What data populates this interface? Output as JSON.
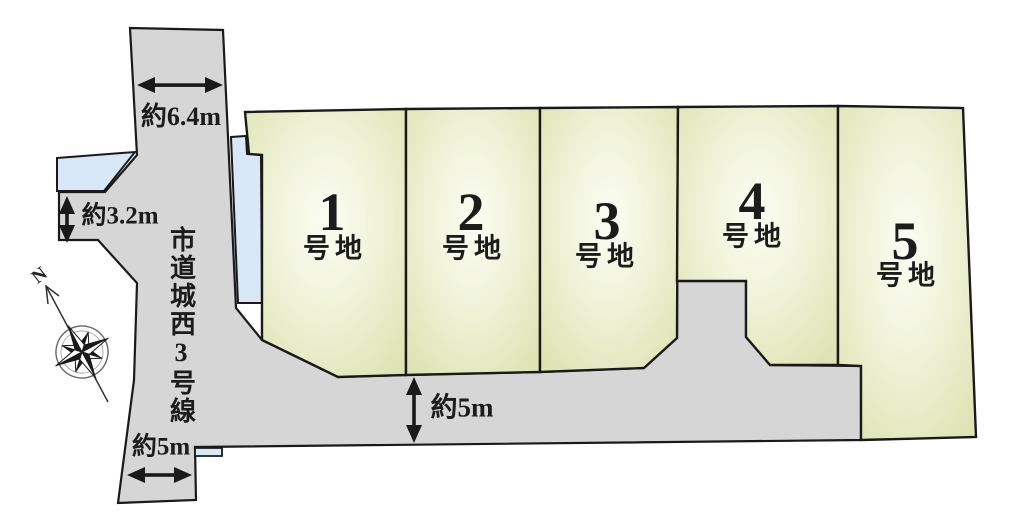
{
  "diagram": {
    "lots": [
      {
        "number": "1",
        "suffix": "号地"
      },
      {
        "number": "2",
        "suffix": "号地"
      },
      {
        "number": "3",
        "suffix": "号地"
      },
      {
        "number": "4",
        "suffix": "号地"
      },
      {
        "number": "5",
        "suffix": "号地"
      }
    ],
    "road_name": "市道城西3号線",
    "dimensions": {
      "north_road_width": "約6.4m",
      "west_spur_width": "約3.2m",
      "south_road_width_left": "約5m",
      "south_road_width_center": "約5m"
    },
    "compass": {
      "north_label": "N"
    },
    "colors": {
      "road_fill": "#d6d6d6",
      "water_fill": "#d9e8f8",
      "lot_fill_center": "#fbfdf1",
      "lot_fill_edge": "#dde3b2",
      "outline": "#1a1a1a"
    }
  }
}
